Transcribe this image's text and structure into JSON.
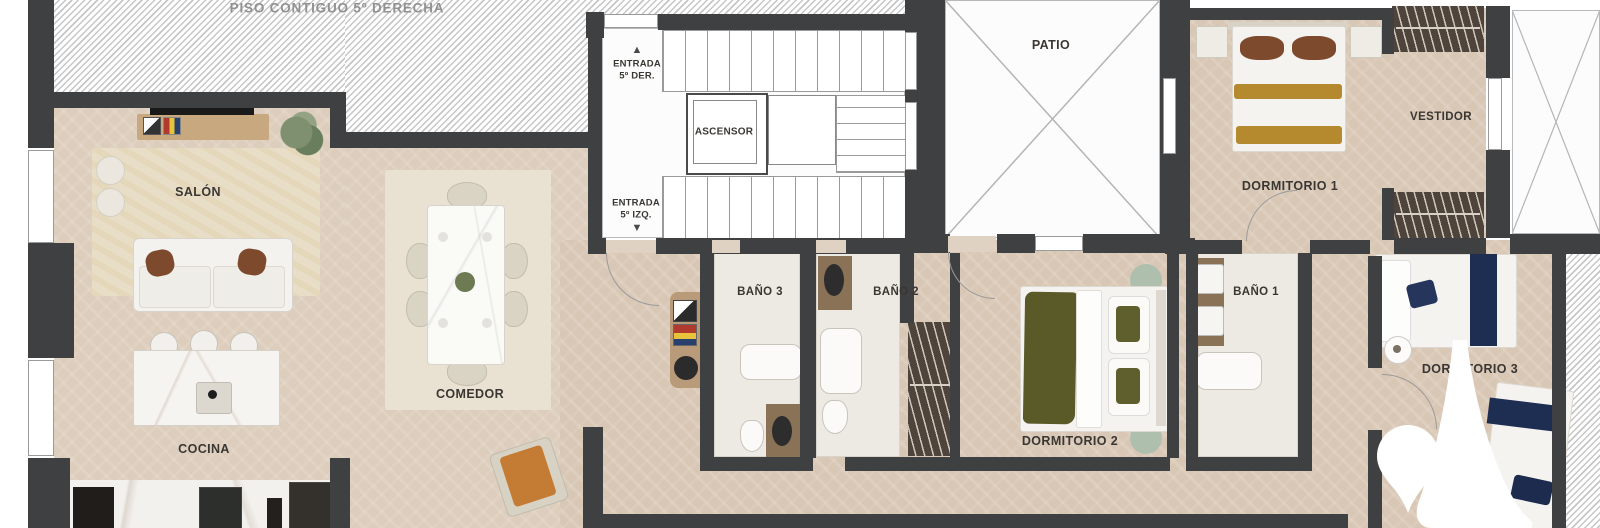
{
  "adjacent_unit_label": "PISO CONTIGUO 5º DERECHA",
  "rooms": {
    "salon": "SALÓN",
    "cocina": "COCINA",
    "comedor": "COMEDOR",
    "patio": "PATIO",
    "ascensor": "ASCENSOR",
    "dormitorio_1": "DORMITORIO 1",
    "dormitorio_2": "DORMITORIO 2",
    "dormitorio_3": "DORMITORIO 3",
    "bano_1": "BAÑO 1",
    "bano_2": "BAÑO 2",
    "bano_3": "BAÑO 3",
    "vestidor": "VESTIDOR"
  },
  "entrances": {
    "der": {
      "line1": "ENTRADA",
      "line2": "5º DER.",
      "arrow": "▲"
    },
    "izq": {
      "line1": "ENTRADA",
      "line2": "5º IZQ.",
      "arrow": "▼"
    }
  },
  "colors": {
    "wall": "#3f4042",
    "floor": "#d9c7b5",
    "bath_floor": "#eceae3",
    "hatch_stripe": "#c6c6c6",
    "label_text": "#3a3733",
    "adjacent_label_text": "#919191",
    "accent_gold": "#b58a2e",
    "accent_olive": "#5a5a28",
    "accent_navy": "#1e2d52",
    "accent_orange": "#c47b33",
    "logo": "#ffffff"
  }
}
